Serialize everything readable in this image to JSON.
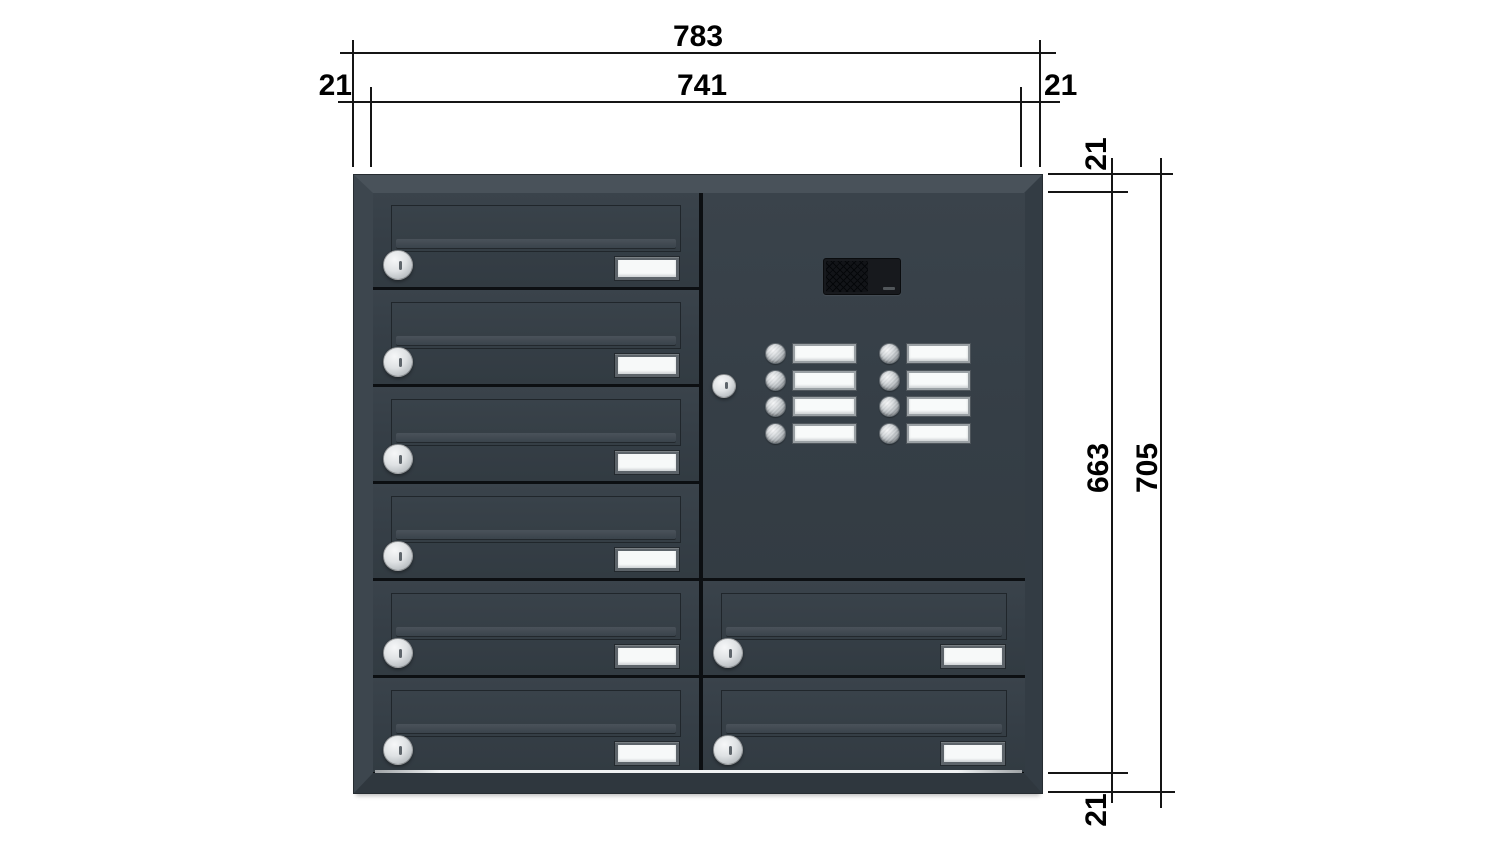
{
  "drawing": {
    "type": "mailbox-unit-dimension-drawing",
    "dimension_labels": {
      "width_outer": "783",
      "width_inner": "741",
      "frame_left": "21",
      "frame_right": "21",
      "frame_top": "21",
      "height_inner": "663",
      "height_outer": "705",
      "frame_bottom": "21"
    },
    "cabinet": {
      "left_column_doors": 6,
      "right_column_doors": 2,
      "intercom": {
        "bell_rows": 4,
        "bell_columns": 2,
        "bell_buttons": 8,
        "has_speaker": true,
        "has_lock": true
      },
      "colors": {
        "frame_top": "#49525A",
        "frame_left": "#3D464E",
        "frame_right": "#333C44",
        "frame_bottom": "#2F373E",
        "door_face": "#353E46",
        "separator": "#0C0F12",
        "lock_silver": "#DFE2E4",
        "nameplate_white": "#F7F9F9",
        "nameplate_frame": "#5D646A",
        "bell_plate_frame": "#9AA0A4",
        "speaker_black": "#17191D",
        "bottom_glint": "#F0F2F3",
        "dimension_line": "#151515"
      }
    }
  }
}
